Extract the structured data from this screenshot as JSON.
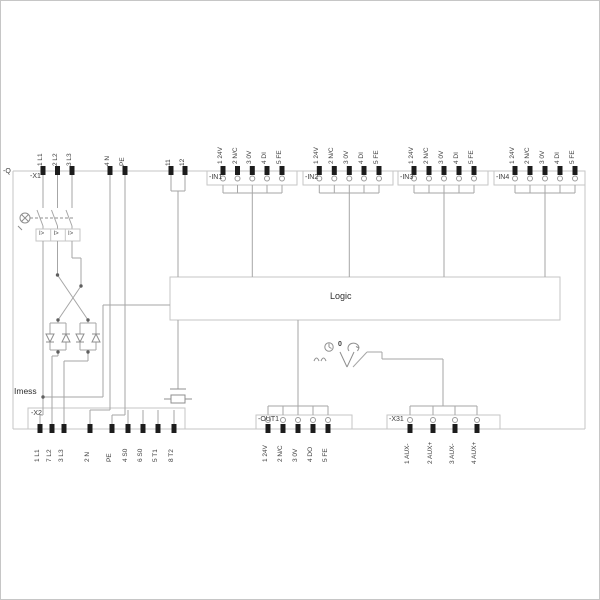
{
  "diagram": {
    "designation": "-Q",
    "logic_label": "Logic",
    "imess_label": "Imess",
    "trip_label": "I>",
    "selector": {
      "left_icon": "clock-icon",
      "position_zero": "0",
      "right_icon": "reset-arrow-icon"
    },
    "colors": {
      "wire": "#a6a6a6",
      "outline": "#c6c6c6",
      "terminal_pin": "#1c1c1c",
      "text": "#3c3c3c"
    },
    "x1": {
      "label": "-X1",
      "terminals": [
        "1 L1",
        "2 L2",
        "3 L3",
        "4 N",
        "PE",
        "11",
        "12"
      ]
    },
    "in1": {
      "label": "-IN1",
      "terminals": [
        "1 24V",
        "2 N/C",
        "3 0V",
        "4 DI",
        "5 FE"
      ]
    },
    "in2": {
      "label": "-IN2",
      "terminals": [
        "1 24V",
        "2 N/C",
        "3 0V",
        "4 DI",
        "5 FE"
      ]
    },
    "in3": {
      "label": "-IN3",
      "terminals": [
        "1 24V",
        "2 N/C",
        "3 0V",
        "4 DI",
        "5 FE"
      ]
    },
    "in4": {
      "label": "-IN4",
      "terminals": [
        "1 24V",
        "2 N/C",
        "3 0V",
        "4 DI",
        "5 FE"
      ]
    },
    "x2": {
      "label": "-X2",
      "terminals": [
        "1 L1",
        "7 L2",
        "3 L3",
        "2 N",
        "PE",
        "4 S0",
        "6 S0",
        "5 T1",
        "8 T2"
      ]
    },
    "out1": {
      "label": "-OUT1",
      "terminals": [
        "1 24V",
        "2 N/C",
        "3 0V",
        "4 DO",
        "5 FE"
      ]
    },
    "x31": {
      "label": "-X31",
      "terminals": [
        "1 AUX-",
        "2 AUX+",
        "3 AUX-",
        "4 AUX+"
      ]
    }
  }
}
